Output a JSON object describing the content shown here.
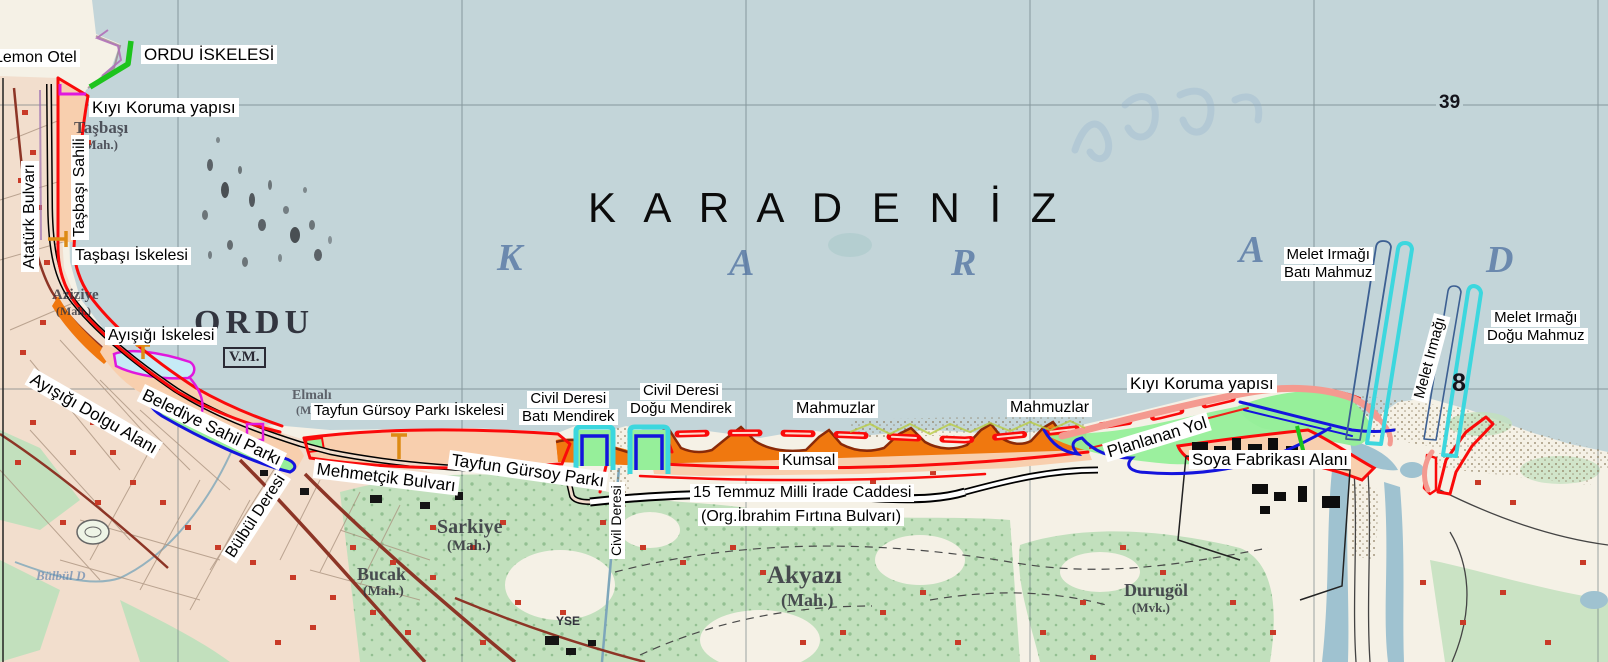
{
  "colors": {
    "sea": "#c3d5d9",
    "land": "#f5f1e6",
    "urban": "#f1dccb",
    "vegetation": "#c2e0bd",
    "annotation_red": "#fa0a0a",
    "annotation_orange": "#f0780f",
    "annotation_peach": "#f8cfae",
    "annotation_green": "#96ef9a",
    "annotation_green_line": "#1dc41d",
    "annotation_blue": "#1414dd",
    "annotation_cyan": "#3cd7de",
    "annotation_magenta": "#e018dd",
    "annotation_pink": "#f49a90",
    "marker_orange": "#dd8b15",
    "map_road_red": "#8d3526",
    "beach_edge": "#8a2a08"
  },
  "sea": {
    "title_overlay": "K A R A D E N İ Z",
    "ghost_letters": [
      "K",
      "A",
      "R",
      "A",
      "D"
    ]
  },
  "grid": {
    "label_39": "39",
    "label_8": "8"
  },
  "base_map_labels": {
    "tasbasi": "Taşbaşı",
    "tasbasi_mah": "(Mah.)",
    "aziziye": "Aziziye",
    "aziziye_mah": "(Mah.)",
    "ordu": "ORDU",
    "ordu_vm": "V.M.",
    "elmali": "Elmalı",
    "elmali_mah": "(Mah.)",
    "sarkiye": "Sarkiye",
    "sarkiye_mah": "(Mah.)",
    "bucak": "Bucak",
    "bucak_mah": "(Mah.)",
    "akyazi": "Akyazı",
    "akyazi_mah": "(Mah.)",
    "durugol": "Durugöl",
    "durugol_mvk": "(Mvk.)",
    "yse": "YSE",
    "ghost_ye": "Ye",
    "ghost_bulbul": "Bülbül D"
  },
  "annotations": {
    "lemon_otel": "Lemon Otel",
    "ordu_iskelesi": "ORDU İSKELESİ",
    "kiyi_koruma_west": "Kıyı Koruma yapısı",
    "tasbasi_sahili": "Taşbaşı Sahili",
    "ataturk_bulvari": "Atatürk Bulvarı",
    "tasbasi_iskelesi": "Taşbaşı İskelesi",
    "ayisigi_iskelesi": "Ayışığı İskelesi",
    "ayisigi_dolgu_alani": "Ayışığı Dolgu Alanı",
    "belediye_sahil_parki": "Belediye Sahil Parkı",
    "bulbul_deresi": "Bülbül Deresi",
    "tayfun_gursoy_parki_iskelesi": "Tayfun Gürsoy Parkı İskelesi",
    "civil_bati_line1": "Civil Deresi",
    "civil_bati_line2": "Batı Mendirek",
    "civil_dogu_line1": "Civil Deresi",
    "civil_dogu_line2": "Doğu Mendirek",
    "mahmuzlar_west": "Mahmuzlar",
    "kumsal": "Kumsal",
    "mehmetcik_bulvari": "Mehmetçik Bulvarı",
    "tayfun_gursoy_parki": "Tayfun Gürsoy Parkı",
    "civil_deresi_vertical": "Civil Deresi",
    "cadde_line1": "15 Temmuz Milli İrade Caddesi",
    "cadde_line2": "(Org.İbrahim Fırtına Bulvarı)",
    "mahmuzlar_east": "Mahmuzlar",
    "kiyi_koruma_east": "Kıyı Koruma yapısı",
    "planlanan_yol": "Planlanan Yol",
    "soya_fabrikasi_alani": "Soya Fabrikası Alanı",
    "melet_bati_line1": "Melet Irmağı",
    "melet_bati_line2": "Batı Mahmuz",
    "melet_irmagi": "Melet Irmağı",
    "melet_dogu_line1": "Melet Irmağı",
    "melet_dogu_line2": "Doğu Mahmuz"
  }
}
